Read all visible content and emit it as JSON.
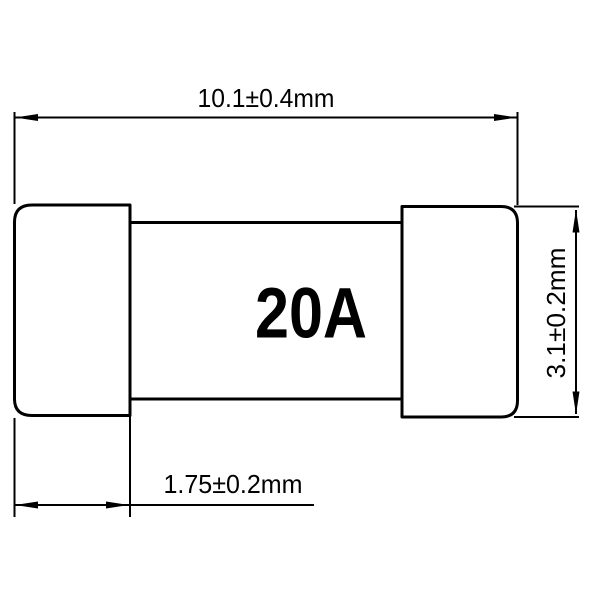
{
  "fuse": {
    "rating_label": "20A"
  },
  "dimensions": {
    "overall_length": {
      "label": "10.1±0.4mm",
      "value": 10.1,
      "tolerance": 0.4,
      "unit": "mm"
    },
    "body_height": {
      "label": "3.1±0.2mm",
      "value": 3.1,
      "tolerance": 0.2,
      "unit": "mm"
    },
    "cap_width": {
      "label": "1.75±0.2mm",
      "value": 1.75,
      "tolerance": 0.2,
      "unit": "mm"
    }
  },
  "colors": {
    "background": "#ffffff",
    "line": "#000000",
    "text": "#000000"
  }
}
